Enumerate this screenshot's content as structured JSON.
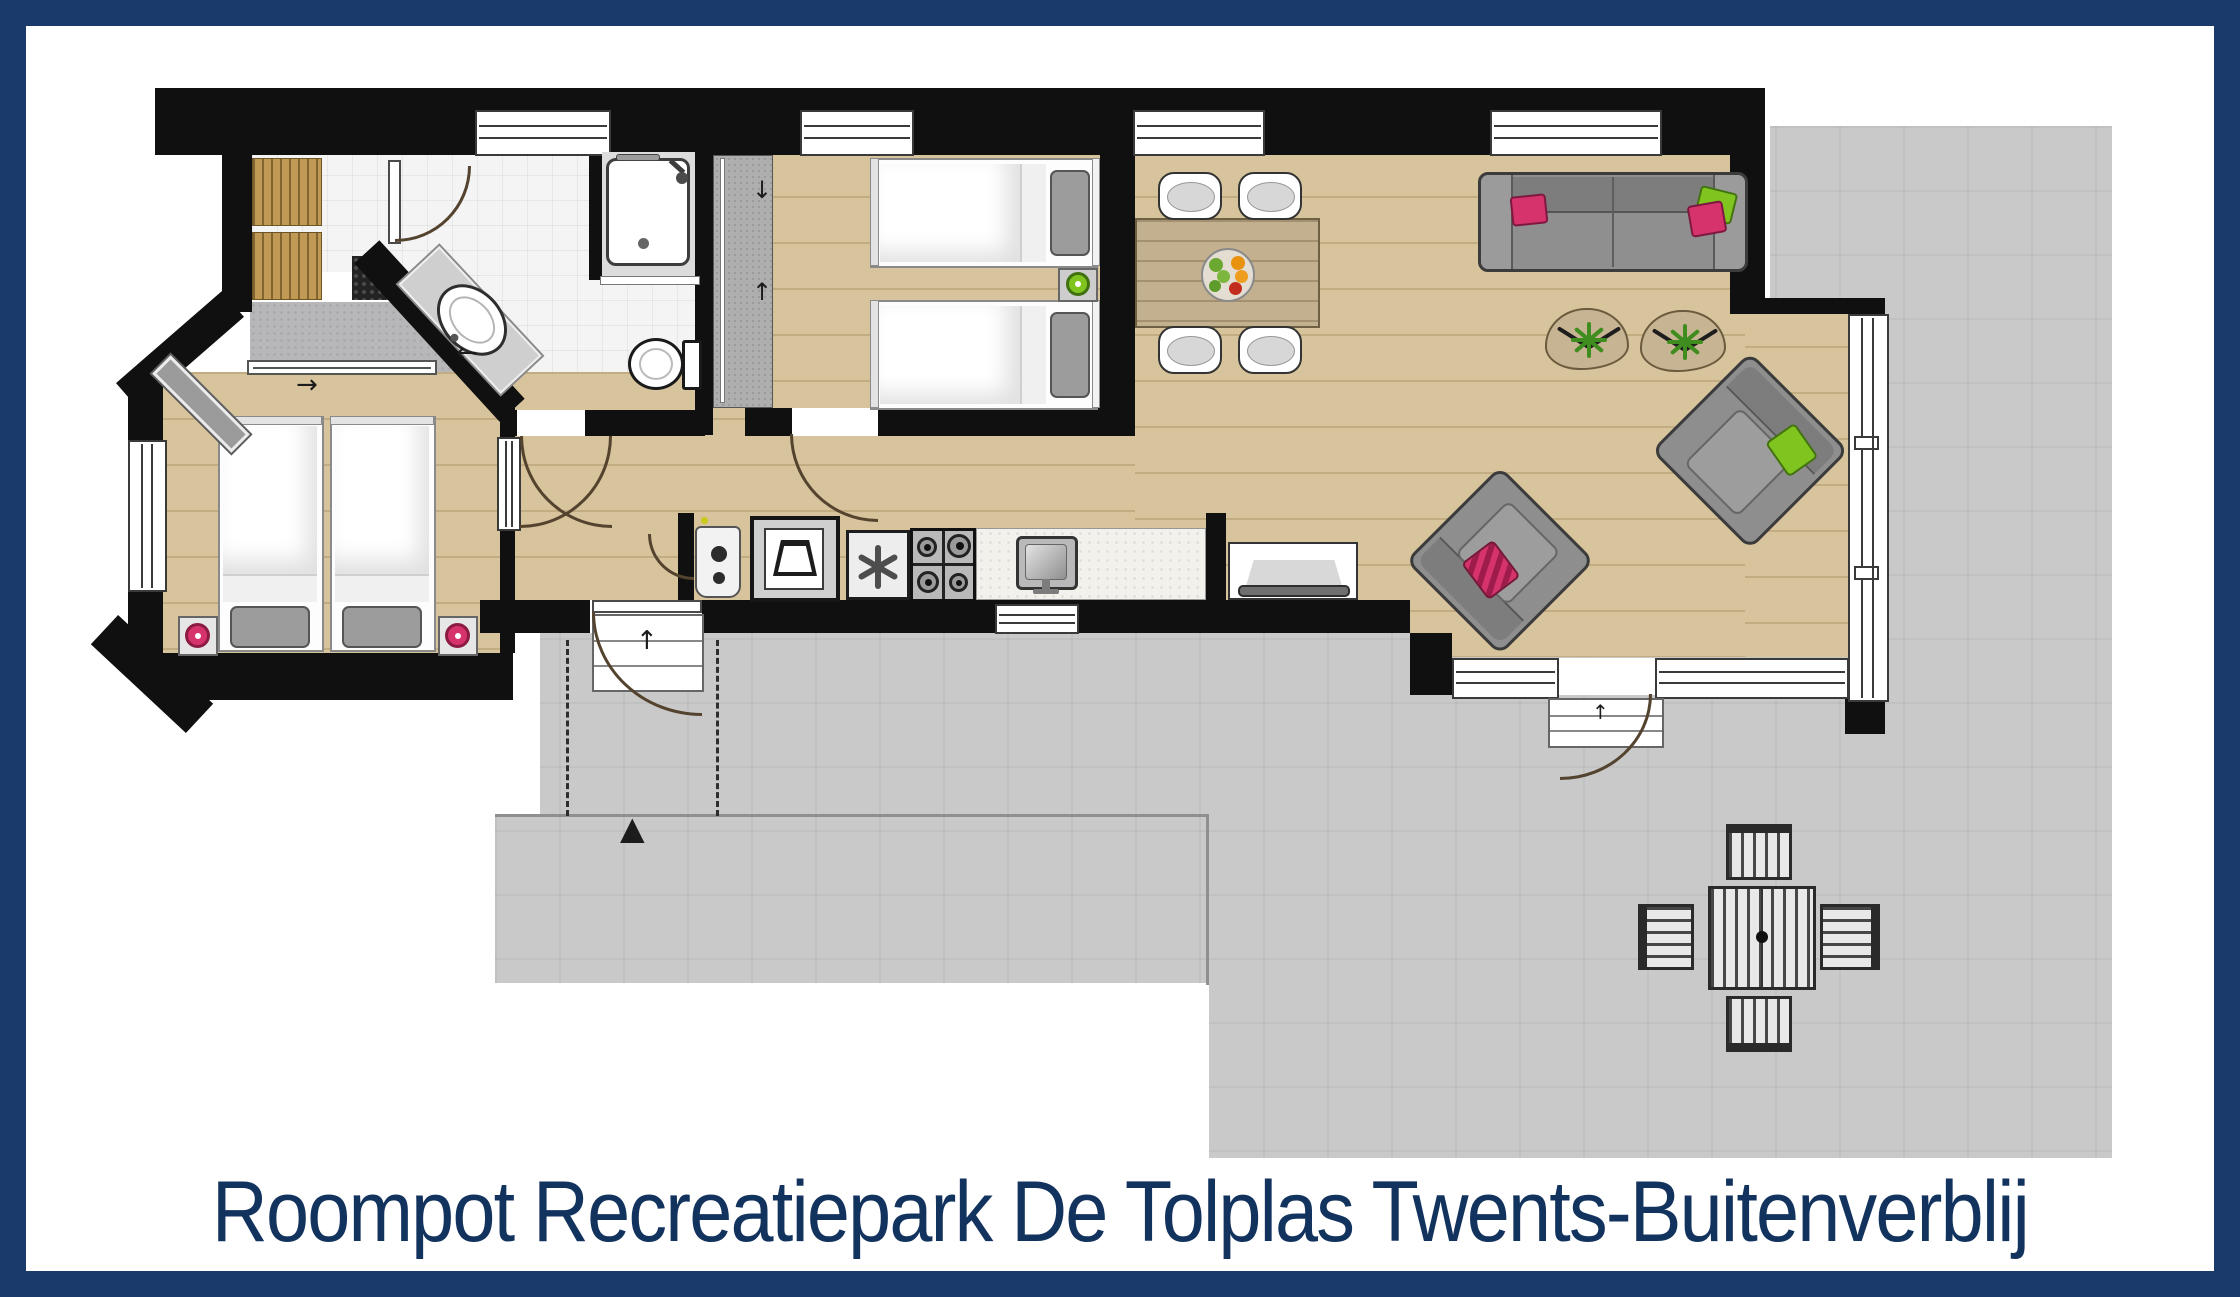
{
  "title": {
    "text": "Roompot Recreatiepark De Tolplas Twents-Buitenverblij"
  },
  "colors": {
    "frame_navy": "#1a3a6b",
    "title_navy": "#13335f",
    "wall_black": "#101010",
    "wood_floor": "#d8c49c",
    "terrace_gray": "#c9c9c9",
    "hall_gray": "#b7b7b9",
    "accent_pink": "#d6336c",
    "accent_green": "#7fc41f"
  },
  "icons": {
    "arrow_up": "↑",
    "arrow_down": "↓",
    "arrow_left": "←",
    "arrow_right": "→",
    "north_marker": "▲"
  }
}
